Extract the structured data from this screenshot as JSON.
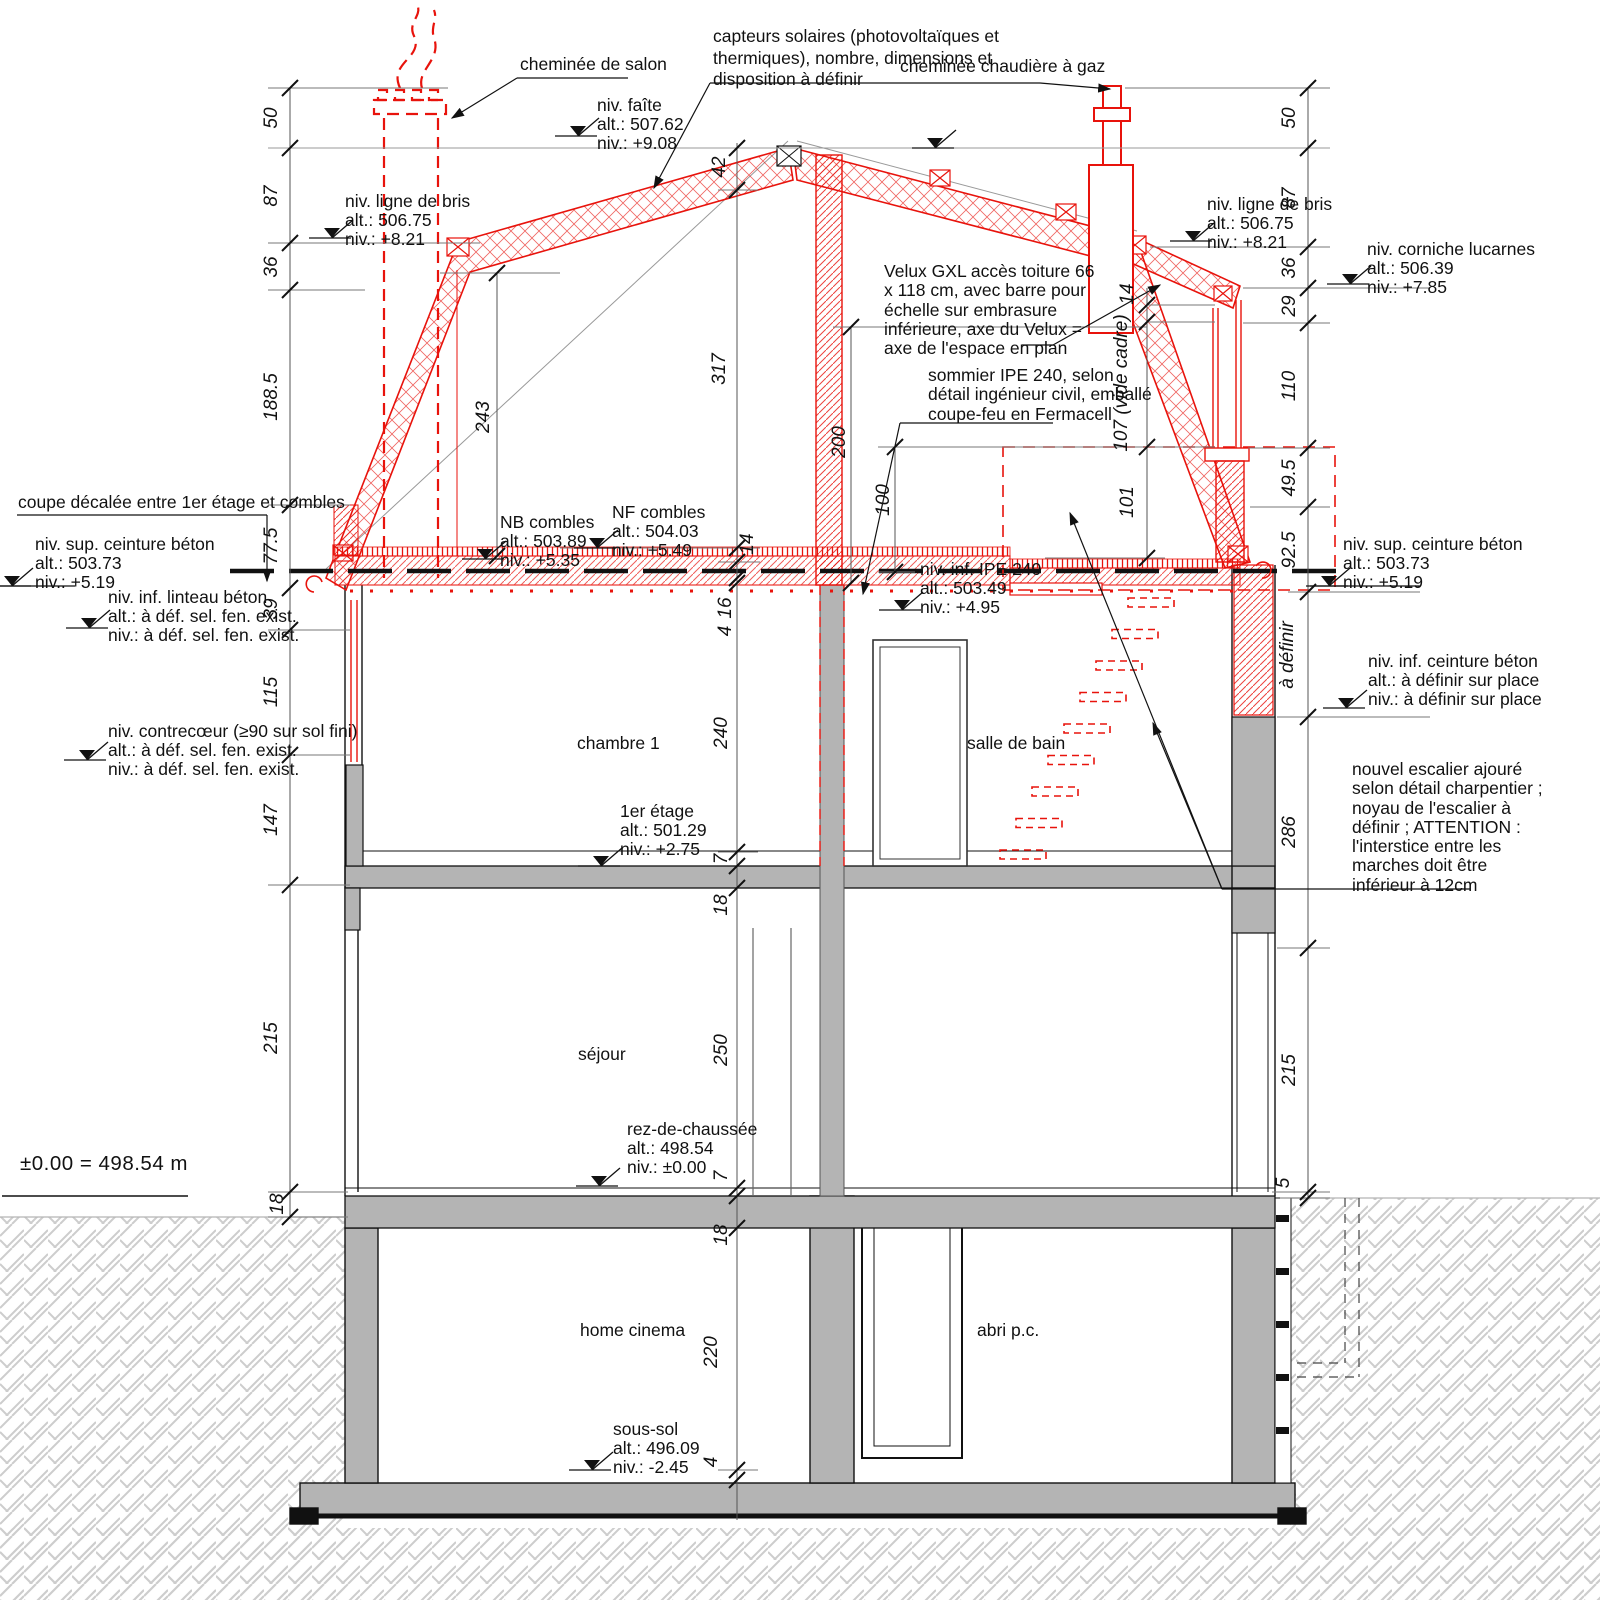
{
  "colors": {
    "red": "#e8130c",
    "wall_grey": "#b4b4b4",
    "hatch_grey": "#c9c9c9",
    "line": "#111111"
  },
  "annotations": {
    "chimney_salon": "cheminée de salon",
    "solar": [
      "capteurs solaires (photovoltaïques et",
      "thermiques), nombre, dimensions et",
      "disposition à définir"
    ],
    "chimney_gas": "cheminée chaudière à gaz",
    "velux": [
      "Velux GXL accès toiture 66",
      "x 118 cm, avec barre pour",
      "échelle sur embrasure",
      "inférieure, axe du Velux =",
      "axe de l'espace en plan"
    ],
    "sommier": [
      "sommier IPE 240, selon",
      "détail ingénieur civil, emballé",
      "coupe-feu en Fermacell"
    ],
    "coupe_decalee": "coupe décalée entre 1er étage et combles",
    "escalier": [
      "nouvel escalier ajouré",
      "selon détail charpentier ;",
      "noyau de l'escalier à",
      "définir ; ATTENTION :",
      "l'interstice entre les",
      "marches doit être",
      "inférieur à 12cm"
    ],
    "datum": "±0.00 =  498.54 m"
  },
  "levels": {
    "faite": {
      "name": "niv. faîte",
      "alt": "alt.: 507.62",
      "niv": "niv.: +9.08"
    },
    "bris_left": {
      "name": "niv. ligne de bris",
      "alt": "alt.: 506.75",
      "niv": "niv.: +8.21"
    },
    "bris_right": {
      "name": "niv. ligne de bris",
      "alt": "alt.: 506.75",
      "niv": "niv.: +8.21"
    },
    "corniche": {
      "name": "niv. corniche lucarnes",
      "alt": "alt.: 506.39",
      "niv": "niv.: +7.85"
    },
    "nb_combles": {
      "name": "NB combles",
      "alt": "alt.: 503.89",
      "niv": "niv.: +5.35"
    },
    "nf_combles": {
      "name": "NF combles",
      "alt": "alt.: 504.03",
      "niv": "niv.: +5.49"
    },
    "ipe": {
      "name": "niv. inf. IPE 240",
      "alt": "alt.: 503.49",
      "niv": "niv.: +4.95"
    },
    "sup_ceinture_left": {
      "name": "niv. sup. ceinture béton",
      "alt": "alt.: 503.73",
      "niv": "niv.: +5.19"
    },
    "linteau": {
      "name": "niv. inf. linteau béton",
      "alt": "alt.: à déf. sel. fen. exist.",
      "niv": "niv.: à déf. sel. fen. exist."
    },
    "contrecoeur": {
      "name": "niv. contrecœur (≥90 sur sol fini)",
      "alt": "alt.: à déf. sel. fen. exist.",
      "niv": "niv.: à déf. sel. fen. exist."
    },
    "etage1": {
      "name": "1er étage",
      "alt": "alt.: 501.29",
      "niv": "niv.: +2.75"
    },
    "sup_ceinture_right": {
      "name": "niv. sup. ceinture béton",
      "alt": "alt.: 503.73",
      "niv": "niv.: +5.19"
    },
    "inf_ceinture_right": {
      "name": "niv. inf. ceinture béton",
      "alt": "alt.: à définir sur place",
      "niv": "niv.: à définir sur place"
    },
    "rdc": {
      "name": "rez-de-chaussée",
      "alt": "alt.: 498.54",
      "niv": "niv.: ±0.00"
    },
    "sous_sol": {
      "name": "sous-sol",
      "alt": "alt.: 496.09",
      "niv": "niv.: -2.45"
    }
  },
  "rooms": {
    "chambre": "chambre 1",
    "bain": "salle de bain",
    "sejour": "séjour",
    "cinema": "home cinema",
    "abri": "abri p.c."
  },
  "dimensions": {
    "labels": [
      {
        "t": "50",
        "x": 272,
        "y": 118
      },
      {
        "t": "87",
        "x": 272,
        "y": 196
      },
      {
        "t": "36",
        "x": 272,
        "y": 267
      },
      {
        "t": "188.5",
        "x": 272,
        "y": 397
      },
      {
        "t": "77.5",
        "x": 272,
        "y": 546
      },
      {
        "t": "39",
        "x": 272,
        "y": 609
      },
      {
        "t": "115",
        "x": 272,
        "y": 692
      },
      {
        "t": "147",
        "x": 272,
        "y": 820
      },
      {
        "t": "215",
        "x": 272,
        "y": 1038
      },
      {
        "t": "18",
        "x": 278,
        "y": 1204
      },
      {
        "t": "50",
        "x": 1290,
        "y": 118
      },
      {
        "t": "87",
        "x": 1290,
        "y": 198
      },
      {
        "t": "36",
        "x": 1290,
        "y": 268
      },
      {
        "t": "29",
        "x": 1290,
        "y": 306
      },
      {
        "t": "110",
        "x": 1290,
        "y": 386
      },
      {
        "t": "49.5",
        "x": 1290,
        "y": 478
      },
      {
        "t": "92.5",
        "x": 1290,
        "y": 550
      },
      {
        "t": "à définir",
        "x": 1288,
        "y": 655
      },
      {
        "t": "286",
        "x": 1290,
        "y": 832
      },
      {
        "t": "215",
        "x": 1290,
        "y": 1070
      },
      {
        "t": "5",
        "x": 1284,
        "y": 1183
      },
      {
        "t": "42",
        "x": 720,
        "y": 167
      },
      {
        "t": "317",
        "x": 720,
        "y": 369
      },
      {
        "t": "14",
        "x": 748,
        "y": 544
      },
      {
        "t": "16",
        "x": 726,
        "y": 608
      },
      {
        "t": "4",
        "x": 726,
        "y": 631
      },
      {
        "t": "240",
        "x": 722,
        "y": 733
      },
      {
        "t": "7",
        "x": 722,
        "y": 859
      },
      {
        "t": "18",
        "x": 722,
        "y": 905
      },
      {
        "t": "250",
        "x": 722,
        "y": 1050
      },
      {
        "t": "7",
        "x": 722,
        "y": 1176
      },
      {
        "t": "18",
        "x": 722,
        "y": 1235
      },
      {
        "t": "220",
        "x": 712,
        "y": 1352
      },
      {
        "t": "4",
        "x": 712,
        "y": 1462
      },
      {
        "t": "243",
        "x": 484,
        "y": 417
      },
      {
        "t": "200",
        "x": 840,
        "y": 442
      },
      {
        "t": "100",
        "x": 884,
        "y": 500
      },
      {
        "t": "14",
        "x": 1128,
        "y": 294
      },
      {
        "t": "107 (vide cadre)",
        "x": 1122,
        "y": 383
      },
      {
        "t": "101",
        "x": 1128,
        "y": 502
      }
    ]
  }
}
